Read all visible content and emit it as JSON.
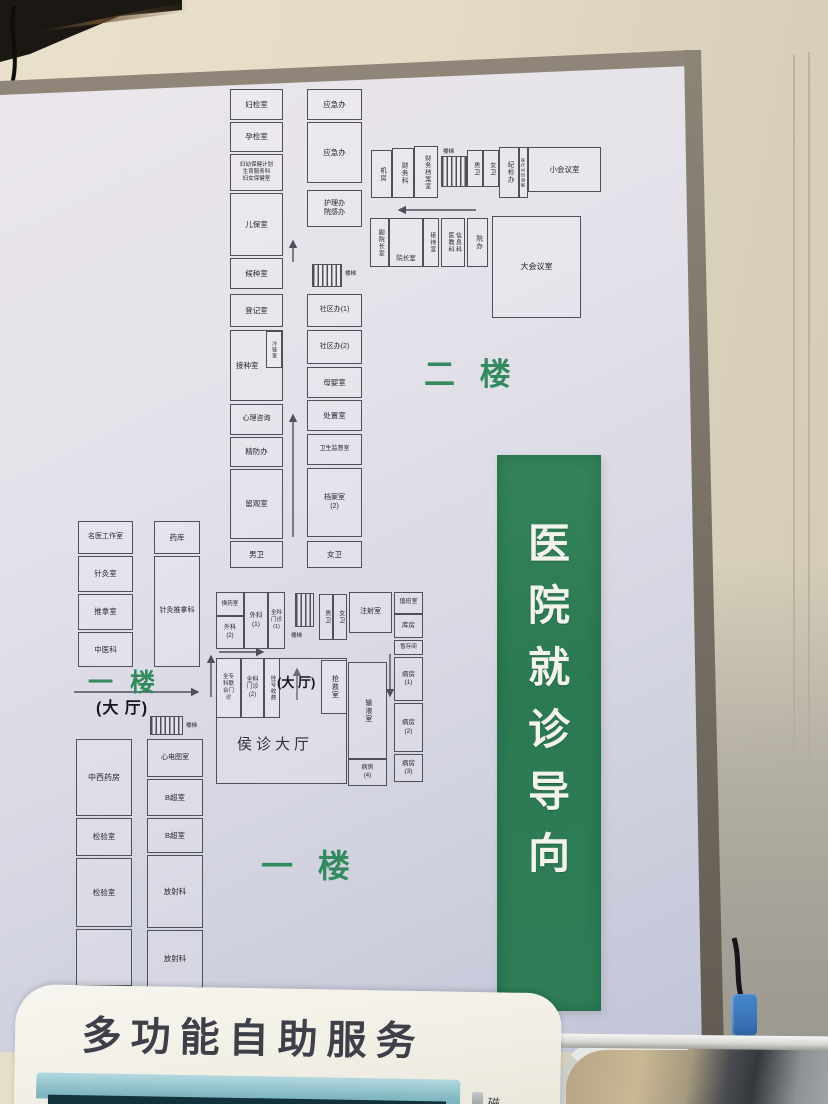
{
  "banner": {
    "chars": [
      "医",
      "院",
      "就",
      "诊",
      "导",
      "向"
    ],
    "bg_color": "#2e7d56",
    "text_color": "#f3f3ee"
  },
  "machine": {
    "title": "多功能自助服务",
    "card_label": "磁"
  },
  "floorplan": {
    "line_color": "#50505a",
    "title_color": "#338a5e",
    "rooms": [
      {
        "x": 230,
        "y": 89,
        "w": 53,
        "h": 31,
        "label": "妇检室"
      },
      {
        "x": 230,
        "y": 122,
        "w": 53,
        "h": 30,
        "label": "孕检室"
      },
      {
        "x": 230,
        "y": 154,
        "w": 53,
        "h": 37,
        "label": "妇幼保健计划\n生育服务科\n妇女保健室",
        "fs": 5.5
      },
      {
        "x": 230,
        "y": 193,
        "w": 53,
        "h": 63,
        "label": "儿保室"
      },
      {
        "x": 230,
        "y": 258,
        "w": 53,
        "h": 31,
        "label": "候种室"
      },
      {
        "x": 230,
        "y": 294,
        "w": 53,
        "h": 33,
        "label": "登记室"
      },
      {
        "x": 230,
        "y": 330,
        "w": 53,
        "h": 71,
        "label": "接种室",
        "ha": "start"
      },
      {
        "x": 266,
        "y": 331,
        "w": 16,
        "h": 37,
        "label": "冷链室",
        "v": true,
        "fs": 5
      },
      {
        "x": 230,
        "y": 404,
        "w": 53,
        "h": 31,
        "label": "心理咨询",
        "fs": 7
      },
      {
        "x": 230,
        "y": 437,
        "w": 53,
        "h": 30,
        "label": "精防办"
      },
      {
        "x": 230,
        "y": 469,
        "w": 53,
        "h": 70,
        "label": "留观室"
      },
      {
        "x": 230,
        "y": 541,
        "w": 53,
        "h": 27,
        "label": "男卫"
      },
      {
        "x": 307,
        "y": 89,
        "w": 55,
        "h": 31,
        "label": "应急办"
      },
      {
        "x": 307,
        "y": 122,
        "w": 55,
        "h": 61,
        "label": "应急办"
      },
      {
        "x": 307,
        "y": 190,
        "w": 55,
        "h": 37,
        "label": "护理办\n院感办",
        "fs": 7
      },
      {
        "x": 307,
        "y": 294,
        "w": 55,
        "h": 33,
        "label": "社区办(1)",
        "fs": 7
      },
      {
        "x": 307,
        "y": 330,
        "w": 55,
        "h": 34,
        "label": "社区办(2)",
        "fs": 7
      },
      {
        "x": 307,
        "y": 367,
        "w": 55,
        "h": 31,
        "label": "母婴室"
      },
      {
        "x": 307,
        "y": 400,
        "w": 55,
        "h": 31,
        "label": "处置室"
      },
      {
        "x": 307,
        "y": 434,
        "w": 55,
        "h": 31,
        "label": "卫生监督室",
        "fs": 6
      },
      {
        "x": 307,
        "y": 468,
        "w": 55,
        "h": 69,
        "label": "档案室\n(2)",
        "fs": 7
      },
      {
        "x": 307,
        "y": 541,
        "w": 55,
        "h": 27,
        "label": "女卫"
      },
      {
        "x": 371,
        "y": 150,
        "w": 21,
        "h": 48,
        "label": "机房",
        "v": true,
        "fs": 6.5
      },
      {
        "x": 392,
        "y": 148,
        "w": 22,
        "h": 50,
        "label": "财务科",
        "v": true,
        "fs": 6.5
      },
      {
        "x": 414,
        "y": 146,
        "w": 24,
        "h": 52,
        "label": "财务档案室",
        "v": true,
        "fs": 6
      },
      {
        "x": 467,
        "y": 150,
        "w": 16,
        "h": 37,
        "label": "男卫",
        "v": true,
        "fs": 6
      },
      {
        "x": 483,
        "y": 150,
        "w": 16,
        "h": 37,
        "label": "女卫",
        "v": true,
        "fs": 6
      },
      {
        "x": 499,
        "y": 147,
        "w": 20,
        "h": 51,
        "label": "纪检办",
        "v": true,
        "fs": 6.5
      },
      {
        "x": 519,
        "y": 147,
        "w": 9,
        "h": 51,
        "label": "医疗纠纷调解",
        "v": true,
        "fs": 4
      },
      {
        "x": 528,
        "y": 147,
        "w": 73,
        "h": 45,
        "label": "小会议室",
        "fs": 7.5
      },
      {
        "x": 370,
        "y": 218,
        "w": 19,
        "h": 49,
        "label": "副院长室",
        "v": true,
        "fs": 6
      },
      {
        "x": 389,
        "y": 218,
        "w": 34,
        "h": 49,
        "label": "院长室",
        "fs": 6.5,
        "va": "end"
      },
      {
        "x": 423,
        "y": 218,
        "w": 16,
        "h": 49,
        "label": "接待室",
        "v": true,
        "fs": 6
      },
      {
        "x": 441,
        "y": 218,
        "w": 24,
        "h": 49,
        "label": "医教科\n信息科",
        "v": true,
        "fs": 6
      },
      {
        "x": 467,
        "y": 218,
        "w": 21,
        "h": 49,
        "label": "院办",
        "v": true,
        "fs": 6.5
      },
      {
        "x": 492,
        "y": 216,
        "w": 89,
        "h": 102,
        "label": "大会议室",
        "fs": 8
      },
      {
        "x": 78,
        "y": 521,
        "w": 55,
        "h": 33,
        "label": "名医工作室",
        "fs": 7
      },
      {
        "x": 78,
        "y": 556,
        "w": 55,
        "h": 36,
        "label": "针灸室"
      },
      {
        "x": 78,
        "y": 594,
        "w": 55,
        "h": 36,
        "label": "推拿室"
      },
      {
        "x": 78,
        "y": 632,
        "w": 55,
        "h": 35,
        "label": "中医科"
      },
      {
        "x": 154,
        "y": 521,
        "w": 46,
        "h": 33,
        "label": "药库"
      },
      {
        "x": 154,
        "y": 556,
        "w": 46,
        "h": 111,
        "label": "针灸推拿科",
        "fs": 7
      },
      {
        "x": 216,
        "y": 592,
        "w": 28,
        "h": 24,
        "label": "换药室",
        "fs": 5.5
      },
      {
        "x": 216,
        "y": 616,
        "w": 28,
        "h": 33,
        "label": "外科\n(2)",
        "fs": 6
      },
      {
        "x": 244,
        "y": 592,
        "w": 24,
        "h": 57,
        "label": "外科\n(1)",
        "fs": 6.5
      },
      {
        "x": 268,
        "y": 592,
        "w": 17,
        "h": 57,
        "label": "全科\n门诊\n(1)",
        "fs": 5.5
      },
      {
        "x": 319,
        "y": 594,
        "w": 14,
        "h": 46,
        "label": "男卫",
        "v": true,
        "fs": 6
      },
      {
        "x": 333,
        "y": 594,
        "w": 14,
        "h": 46,
        "label": "女卫",
        "v": true,
        "fs": 6
      },
      {
        "x": 349,
        "y": 592,
        "w": 43,
        "h": 41,
        "label": "注射室",
        "fs": 7
      },
      {
        "x": 216,
        "y": 658,
        "w": 131,
        "h": 126,
        "label": ""
      },
      {
        "x": 216,
        "y": 658,
        "w": 25,
        "h": 60,
        "label": "全专\n科联\n合门\n诊",
        "fs": 5.5
      },
      {
        "x": 241,
        "y": 658,
        "w": 23,
        "h": 60,
        "label": "全科\n门诊\n(2)",
        "fs": 6
      },
      {
        "x": 264,
        "y": 658,
        "w": 16,
        "h": 60,
        "label": "挂号收费",
        "v": true,
        "fs": 5.5
      },
      {
        "x": 321,
        "y": 660,
        "w": 26,
        "h": 54,
        "label": "抢救室",
        "v": true,
        "fs": 7
      },
      {
        "x": 348,
        "y": 662,
        "w": 39,
        "h": 97,
        "label": "输液室",
        "v": true,
        "fs": 7
      },
      {
        "x": 348,
        "y": 759,
        "w": 39,
        "h": 27,
        "label": "病房\n(4)",
        "fs": 6
      },
      {
        "x": 394,
        "y": 592,
        "w": 29,
        "h": 22,
        "label": "值班室",
        "fs": 6
      },
      {
        "x": 394,
        "y": 614,
        "w": 29,
        "h": 24,
        "label": "库房",
        "fs": 6.5
      },
      {
        "x": 394,
        "y": 640,
        "w": 29,
        "h": 15,
        "label": "暂存间",
        "fs": 5.5
      },
      {
        "x": 394,
        "y": 657,
        "w": 29,
        "h": 44,
        "label": "病房\n(1)",
        "fs": 6.5
      },
      {
        "x": 394,
        "y": 703,
        "w": 29,
        "h": 49,
        "label": "病房\n(2)",
        "fs": 6.5
      },
      {
        "x": 394,
        "y": 754,
        "w": 29,
        "h": 28,
        "label": "病房\n(3)",
        "fs": 6.5
      },
      {
        "x": 76,
        "y": 739,
        "w": 56,
        "h": 77,
        "label": "中西药房",
        "fs": 8
      },
      {
        "x": 76,
        "y": 818,
        "w": 56,
        "h": 38,
        "label": "检验室"
      },
      {
        "x": 76,
        "y": 858,
        "w": 56,
        "h": 69,
        "label": "检验室"
      },
      {
        "x": 76,
        "y": 929,
        "w": 56,
        "h": 57,
        "label": ""
      },
      {
        "x": 147,
        "y": 739,
        "w": 56,
        "h": 38,
        "label": "心电图室",
        "fs": 7
      },
      {
        "x": 147,
        "y": 779,
        "w": 56,
        "h": 37,
        "label": "B超室"
      },
      {
        "x": 147,
        "y": 818,
        "w": 56,
        "h": 35,
        "label": "B超室"
      },
      {
        "x": 147,
        "y": 855,
        "w": 56,
        "h": 73,
        "label": "放射科"
      },
      {
        "x": 147,
        "y": 930,
        "w": 56,
        "h": 58,
        "label": "放射科"
      }
    ],
    "stairs": [
      {
        "x": 312,
        "y": 264,
        "w": 30,
        "h": 23,
        "label": "楼梯",
        "lx": 345,
        "ly": 269
      },
      {
        "x": 441,
        "y": 156,
        "w": 26,
        "h": 31,
        "label": "楼梯",
        "lx": 443,
        "ly": 147
      },
      {
        "x": 295,
        "y": 593,
        "w": 19,
        "h": 34,
        "label": "楼梯",
        "lx": 291,
        "ly": 631
      },
      {
        "x": 150,
        "y": 716,
        "w": 33,
        "h": 19,
        "label": "楼梯",
        "lx": 186,
        "ly": 721
      }
    ],
    "arrows": [
      {
        "x1": 293,
        "y1": 262,
        "x2": 293,
        "y2": 241
      },
      {
        "x1": 293,
        "y1": 537,
        "x2": 293,
        "y2": 415
      },
      {
        "x1": 476,
        "y1": 210,
        "x2": 399,
        "y2": 210
      },
      {
        "x1": 74,
        "y1": 692,
        "x2": 198,
        "y2": 692
      },
      {
        "x1": 219,
        "y1": 652,
        "x2": 263,
        "y2": 652
      },
      {
        "x1": 297,
        "y1": 700,
        "x2": 297,
        "y2": 669
      },
      {
        "x1": 211,
        "y1": 697,
        "x2": 211,
        "y2": 656
      },
      {
        "x1": 390,
        "y1": 654,
        "x2": 390,
        "y2": 696
      }
    ],
    "labels": [
      {
        "text": "二 楼",
        "x": 424,
        "y": 349,
        "fs": 31,
        "color": "#338a5e",
        "bold": true,
        "ls": 8
      },
      {
        "text": "一 楼",
        "x": 88,
        "y": 663,
        "fs": 25,
        "color": "#338a5e",
        "bold": true,
        "ls": 5
      },
      {
        "text": "(大 厅)",
        "x": 96,
        "y": 694,
        "fs": 16,
        "color": "#15161c",
        "bold": true,
        "ls": 1
      },
      {
        "text": "(大 厅)",
        "x": 277,
        "y": 672,
        "fs": 13,
        "color": "#15161c",
        "bold": true,
        "ls": 0
      },
      {
        "text": "侯诊大厅",
        "x": 237,
        "y": 733,
        "fs": 15,
        "color": "#303138",
        "bold": false,
        "ls": 4
      },
      {
        "text": "一 楼",
        "x": 261,
        "y": 841,
        "fs": 32,
        "color": "#338a5e",
        "bold": true,
        "ls": 8
      }
    ]
  }
}
